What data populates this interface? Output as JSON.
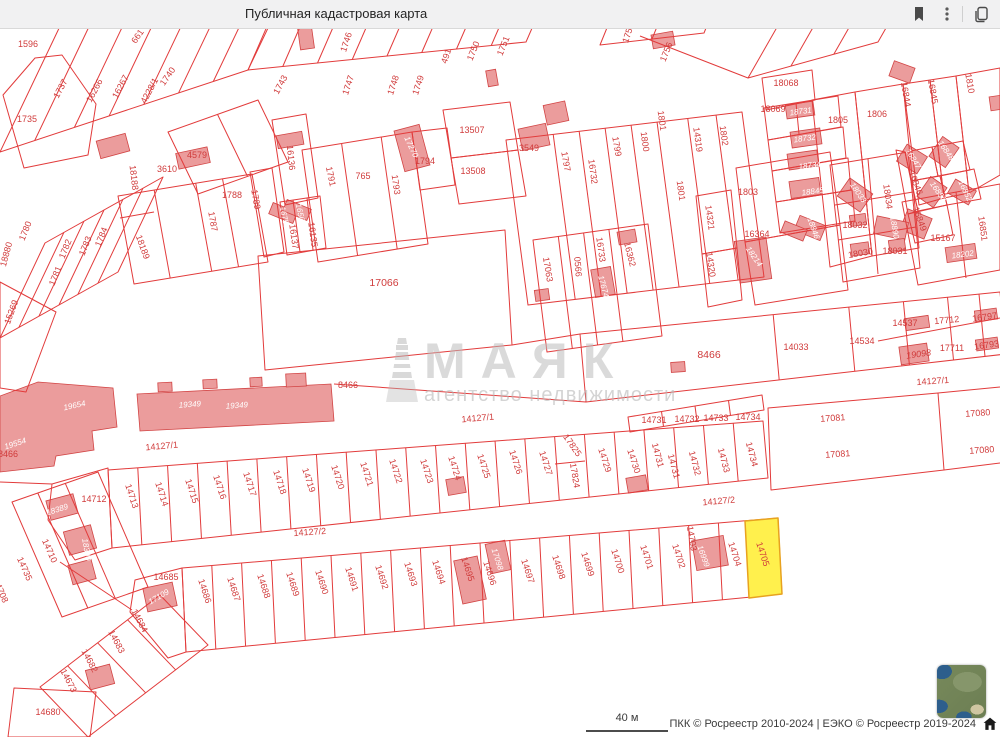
{
  "header": {
    "title": "Публичная кадастровая карта",
    "icons": [
      "bookmark-icon",
      "kebab-menu-icon",
      "tabs-icon"
    ]
  },
  "map": {
    "colors": {
      "parcel_line": "#e23b3b",
      "building_fill": "#eb9c9c",
      "building_stroke": "#d24444",
      "label": "#d03b3b",
      "white_label": "#ffffff",
      "highlight_fill": "#fff04d",
      "highlight_stroke": "#e8a21f"
    },
    "watermark": {
      "title": "МАЯК",
      "subtitle": "агентство недвижимости"
    },
    "highlighted_parcel": "14705",
    "labels": [
      [
        "1596",
        28,
        47,
        0
      ],
      [
        "661",
        140,
        38,
        -55
      ],
      [
        "1737",
        63,
        90,
        -62
      ],
      [
        "16266",
        97,
        92,
        -62
      ],
      [
        "16267",
        123,
        88,
        -62
      ],
      [
        "4228/1",
        152,
        92,
        -62
      ],
      [
        "1740",
        170,
        78,
        -55
      ],
      [
        "1743",
        283,
        86,
        -62
      ],
      [
        "1746",
        349,
        43,
        -72
      ],
      [
        "1747",
        351,
        86,
        -72
      ],
      [
        "1748",
        396,
        86,
        -72
      ],
      [
        "1749",
        421,
        86,
        -72
      ],
      [
        "491",
        449,
        57,
        -72
      ],
      [
        "1750",
        476,
        52,
        -68
      ],
      [
        "1751",
        506,
        47,
        -68
      ],
      [
        "1755",
        631,
        34,
        -72
      ],
      [
        "1756",
        669,
        53,
        -68
      ],
      [
        "1735",
        27,
        122,
        0
      ],
      [
        "4579",
        197,
        158,
        0
      ],
      [
        "18188",
        131,
        178,
        83
      ],
      [
        "3610",
        167,
        172,
        0
      ],
      [
        "1788",
        232,
        198,
        0
      ],
      [
        "1787",
        210,
        222,
        80
      ],
      [
        "18189",
        140,
        248,
        70
      ],
      [
        "18880",
        9,
        255,
        -75
      ],
      [
        "1780",
        28,
        232,
        -68
      ],
      [
        "1782",
        68,
        250,
        -68
      ],
      [
        "1781",
        58,
        277,
        -68
      ],
      [
        "1783",
        88,
        247,
        -68
      ],
      [
        "1784",
        104,
        238,
        -68
      ],
      [
        "15269",
        14,
        313,
        -70
      ],
      [
        "16136",
        288,
        158,
        84
      ],
      [
        "1789",
        253,
        200,
        80
      ],
      [
        "1791",
        328,
        177,
        78
      ],
      [
        "765",
        363,
        179,
        0
      ],
      [
        "1793",
        393,
        185,
        82
      ],
      [
        "17270",
        409,
        148,
        65,
        "w"
      ],
      [
        "1794",
        425,
        164,
        0
      ],
      [
        "13507",
        472,
        133,
        0
      ],
      [
        "13508",
        473,
        174,
        0
      ],
      [
        "3549",
        529,
        151,
        0
      ],
      [
        "1797",
        563,
        162,
        80
      ],
      [
        "16732",
        590,
        172,
        82
      ],
      [
        "1799",
        614,
        147,
        80
      ],
      [
        "1800",
        642,
        142,
        82
      ],
      [
        "1801",
        659,
        121,
        82
      ],
      [
        "1801",
        678,
        191,
        82
      ],
      [
        "14319",
        695,
        140,
        82
      ],
      [
        "1802",
        721,
        136,
        82
      ],
      [
        "16756",
        282,
        218,
        78,
        "w"
      ],
      [
        "16569",
        298,
        215,
        78,
        "w"
      ],
      [
        "16137",
        291,
        237,
        82
      ],
      [
        "16135",
        310,
        235,
        82
      ],
      [
        "17066",
        384,
        286,
        0,
        "lg"
      ],
      [
        "17063",
        545,
        270,
        80
      ],
      [
        "0566",
        575,
        267,
        85
      ],
      [
        "16733",
        598,
        250,
        82
      ],
      [
        "16362",
        627,
        255,
        76
      ],
      [
        "17674",
        601,
        287,
        75,
        "w"
      ],
      [
        "14321",
        707,
        218,
        82
      ],
      [
        "14320",
        708,
        265,
        82
      ],
      [
        "16364",
        757,
        237,
        0
      ],
      [
        "18214",
        752,
        258,
        55,
        "w"
      ],
      [
        "1803",
        748,
        195,
        0
      ],
      [
        "18068",
        786,
        86,
        0
      ],
      [
        "18069",
        773,
        112,
        0
      ],
      [
        "18731",
        801,
        114,
        -8,
        "w"
      ],
      [
        "18732",
        805,
        141,
        -8,
        "w"
      ],
      [
        "18734",
        810,
        168,
        -8,
        "w"
      ],
      [
        "18845",
        813,
        194,
        -8,
        "w"
      ],
      [
        "1805",
        838,
        123,
        0
      ],
      [
        "1806",
        877,
        117,
        0
      ],
      [
        "16844",
        903,
        95,
        80
      ],
      [
        "16845",
        930,
        92,
        80
      ],
      [
        "1810",
        967,
        84,
        80
      ],
      [
        "16846",
        913,
        184,
        70
      ],
      [
        "16847",
        911,
        160,
        58,
        "w"
      ],
      [
        "16848",
        944,
        152,
        55,
        "w"
      ],
      [
        "16849",
        917,
        220,
        70
      ],
      [
        "16850",
        936,
        193,
        55,
        "w"
      ],
      [
        "16852",
        963,
        192,
        65,
        "w"
      ],
      [
        "16851",
        980,
        229,
        82
      ],
      [
        "18033",
        856,
        194,
        55,
        "w"
      ],
      [
        "18034",
        885,
        197,
        82
      ],
      [
        "18032",
        855,
        228,
        0
      ],
      [
        "18890",
        892,
        228,
        80,
        "w"
      ],
      [
        "18030",
        861,
        256,
        -10
      ],
      [
        "18031",
        895,
        254,
        0
      ],
      [
        "15167",
        943,
        241,
        0
      ],
      [
        "18202",
        963,
        257,
        -8,
        "w"
      ],
      [
        "18846",
        811,
        229,
        70,
        "w"
      ],
      [
        "8466",
        709,
        358,
        0,
        "lg"
      ],
      [
        "14033",
        796,
        350,
        0
      ],
      [
        "14534",
        862,
        344,
        0
      ],
      [
        "14537",
        905,
        326,
        0
      ],
      [
        "17712",
        947,
        323,
        -5
      ],
      [
        "16797",
        985,
        320,
        -8
      ],
      [
        "19098",
        919,
        357,
        -8,
        "i"
      ],
      [
        "17711",
        952,
        351,
        0
      ],
      [
        "16793",
        987,
        348,
        -8
      ],
      [
        "14127/1",
        933,
        384,
        -4
      ],
      [
        "8466",
        348,
        388,
        0
      ],
      [
        "19654",
        75,
        408,
        -12,
        "w"
      ],
      [
        "19349",
        190,
        407,
        -4,
        "w"
      ],
      [
        "19349",
        237,
        408,
        -4,
        "w"
      ],
      [
        "19554",
        16,
        446,
        -18,
        "w"
      ],
      [
        "8466",
        8,
        457,
        0
      ],
      [
        "14127/1",
        162,
        449,
        -5
      ],
      [
        "14127/1",
        478,
        421,
        -5
      ],
      [
        "17081",
        833,
        421,
        -4
      ],
      [
        "17081",
        838,
        457,
        -4
      ],
      [
        "17080",
        978,
        416,
        -4
      ],
      [
        "17080",
        982,
        453,
        -4
      ],
      [
        "14127/2",
        719,
        504,
        -5
      ],
      [
        "14127/2",
        310,
        535,
        -4
      ],
      [
        "14712",
        94,
        502,
        0
      ],
      [
        "14713",
        129,
        497,
        72
      ],
      [
        "14714",
        159,
        495,
        72
      ],
      [
        "14715",
        189,
        492,
        72
      ],
      [
        "14716",
        217,
        488,
        72
      ],
      [
        "14717",
        247,
        485,
        72
      ],
      [
        "14718",
        277,
        483,
        72
      ],
      [
        "14719",
        306,
        481,
        72
      ],
      [
        "14720",
        335,
        478,
        72
      ],
      [
        "14721",
        364,
        475,
        72
      ],
      [
        "14722",
        393,
        472,
        72
      ],
      [
        "14723",
        424,
        472,
        72
      ],
      [
        "14724",
        452,
        469,
        72
      ],
      [
        "14725",
        481,
        467,
        72
      ],
      [
        "14726",
        513,
        463,
        72
      ],
      [
        "14727",
        543,
        464,
        72
      ],
      [
        "17825",
        570,
        447,
        55
      ],
      [
        "17824",
        572,
        476,
        80
      ],
      [
        "14729",
        602,
        461,
        72
      ],
      [
        "14730",
        631,
        462,
        72
      ],
      [
        "14731",
        655,
        456,
        75
      ],
      [
        "14731",
        671,
        467,
        75
      ],
      [
        "14732",
        692,
        464,
        75
      ],
      [
        "14733",
        721,
        461,
        75
      ],
      [
        "14734",
        749,
        455,
        75
      ],
      [
        "14731",
        654,
        423,
        0
      ],
      [
        "14732",
        687,
        422,
        0
      ],
      [
        "14733",
        716,
        421,
        0
      ],
      [
        "14734",
        748,
        420,
        0
      ],
      [
        "14685",
        166,
        580,
        0
      ],
      [
        "17109",
        160,
        599,
        -30,
        "w"
      ],
      [
        "14686",
        202,
        592,
        72
      ],
      [
        "14687",
        231,
        590,
        72
      ],
      [
        "14688",
        261,
        587,
        72
      ],
      [
        "14689",
        290,
        585,
        72
      ],
      [
        "14690",
        319,
        583,
        72
      ],
      [
        "14691",
        349,
        580,
        72
      ],
      [
        "14692",
        379,
        578,
        72
      ],
      [
        "14693",
        408,
        575,
        72
      ],
      [
        "14694",
        436,
        573,
        72
      ],
      [
        "14695",
        465,
        570,
        72
      ],
      [
        "17098",
        495,
        560,
        72,
        "w"
      ],
      [
        "14696",
        487,
        574,
        72
      ],
      [
        "14697",
        525,
        572,
        72
      ],
      [
        "14698",
        556,
        568,
        72
      ],
      [
        "14699",
        585,
        565,
        72
      ],
      [
        "14700",
        615,
        562,
        72
      ],
      [
        "14701",
        644,
        558,
        72
      ],
      [
        "14702",
        676,
        557,
        72
      ],
      [
        "14703",
        689,
        539,
        80
      ],
      [
        "16999",
        701,
        557,
        70,
        "w"
      ],
      [
        "14704",
        732,
        555,
        72
      ],
      [
        "14705",
        760,
        555,
        72
      ],
      [
        "18389",
        58,
        512,
        -18,
        "w"
      ],
      [
        "18390",
        84,
        550,
        80,
        "w"
      ],
      [
        "14710",
        47,
        552,
        66
      ],
      [
        "14735",
        22,
        570,
        66
      ],
      [
        "14708",
        -2,
        592,
        66
      ],
      [
        "14684",
        137,
        622,
        62
      ],
      [
        "14683",
        114,
        643,
        62
      ],
      [
        "14682",
        87,
        662,
        62
      ],
      [
        "14673",
        66,
        682,
        62
      ],
      [
        "14680",
        48,
        715,
        0
      ]
    ]
  },
  "footer": {
    "scale_label": "40 м",
    "attribution": "ПКК © Росреестр 2010-2024 | ЕЭКО © Росреестр 2019-2024"
  }
}
